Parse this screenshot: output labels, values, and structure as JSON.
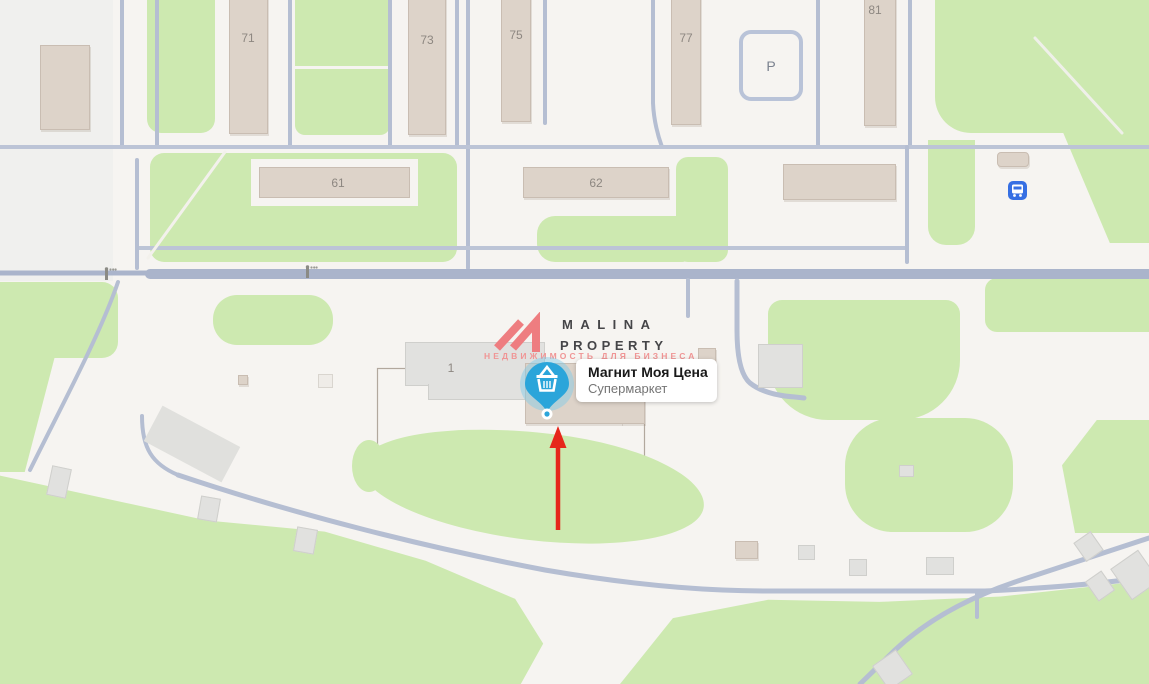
{
  "map": {
    "building_labels": {
      "b71": "71",
      "b73": "73",
      "b75": "75",
      "b77": "77",
      "b81": "81",
      "b61": "61",
      "b62": "62",
      "b1": "1",
      "parking": "P"
    },
    "poi": {
      "title": "Магнит Моя Цена",
      "subtitle": "Супермаркет",
      "icon": "basket-icon"
    },
    "watermark": {
      "brand_line1": "MALINA",
      "brand_line2": "PROPERTY",
      "tagline": "НЕДВИЖИМОСТЬ ДЛЯ БИЗНЕСА"
    },
    "colors": {
      "background": "#f6f4f1",
      "green_area": "#cde9b0",
      "road_main": "#aab4cb",
      "road_thin": "#b5bed2",
      "building_beige": "#ddd3c9",
      "building_gray": "#e1e1df",
      "pin_blue": "#2ba5da",
      "bus_blue": "#366fe3",
      "arrow_red": "#e6261b",
      "logo_pink": "#ee7d80",
      "label_text": "#8d8781"
    }
  }
}
